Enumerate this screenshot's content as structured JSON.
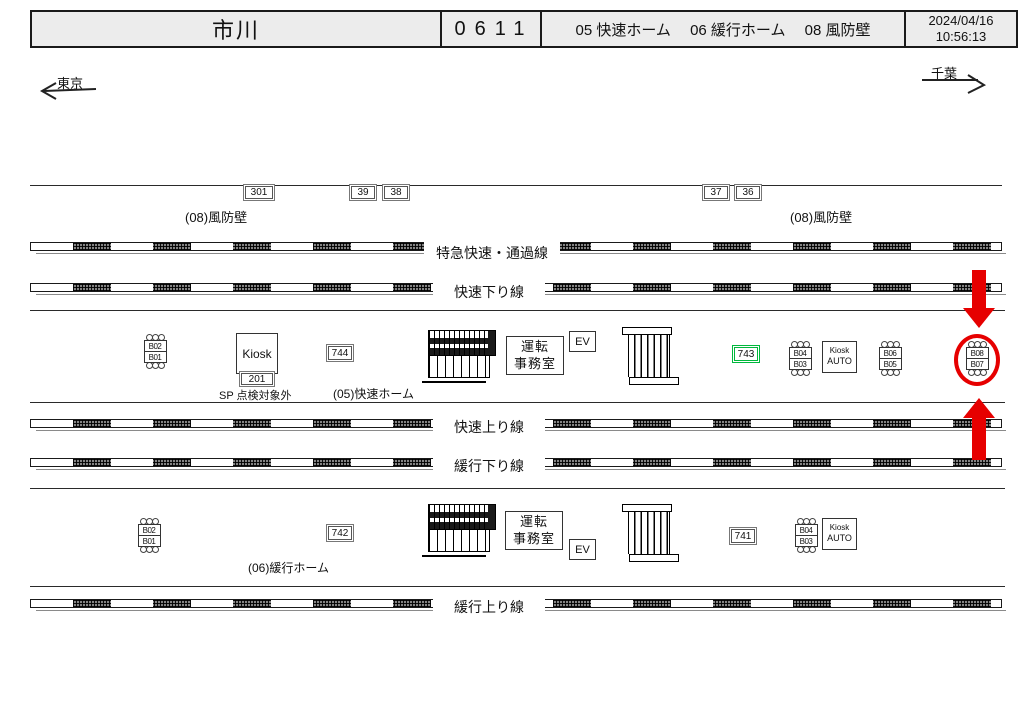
{
  "header": {
    "station": "市川",
    "code": "0611",
    "platforms": "05 快速ホーム　 06 緩行ホーム　 08 風防壁",
    "date": "2024/04/16",
    "time": "10:56:13"
  },
  "directions": {
    "left": "東京",
    "right": "千葉"
  },
  "windbreak": {
    "m301": "301",
    "m39": "39",
    "m38": "38",
    "m37": "37",
    "m36": "36",
    "left_label": "(08)風防壁",
    "right_label": "(08)風防壁"
  },
  "tracks": {
    "express": "特急快速・通過線",
    "rapid_down": "快速下り線",
    "rapid_up": "快速上り線",
    "local_down": "緩行下り線",
    "local_up": "緩行上り線"
  },
  "rapid_platform": {
    "label": "(05)快速ホーム",
    "bench_l_top": "B02",
    "bench_l_bot": "B01",
    "kiosk": "Kiosk",
    "kiosk_no": "201",
    "sp_note": "SP 点検対象外",
    "m744": "744",
    "office1": "運転",
    "office2": "事務室",
    "ev": "EV",
    "m743": "743",
    "bench_m_top": "B04",
    "bench_m_bot": "B03",
    "kiosk_auto1": "Kiosk",
    "kiosk_auto2": "AUTO",
    "bench_r_top": "B06",
    "bench_r_bot": "B05",
    "bench_h_top": "B08",
    "bench_h_bot": "B07"
  },
  "local_platform": {
    "label": "(06)緩行ホーム",
    "bench_l_top": "B02",
    "bench_l_bot": "B01",
    "m742": "742",
    "office1": "運転",
    "office2": "事務室",
    "ev": "EV",
    "m741": "741",
    "bench_top": "B04",
    "bench_bot": "B03",
    "kiosk_auto1": "Kiosk",
    "kiosk_auto2": "AUTO"
  },
  "colors": {
    "highlight": "#e60000",
    "green_marker": "#00b83c"
  }
}
